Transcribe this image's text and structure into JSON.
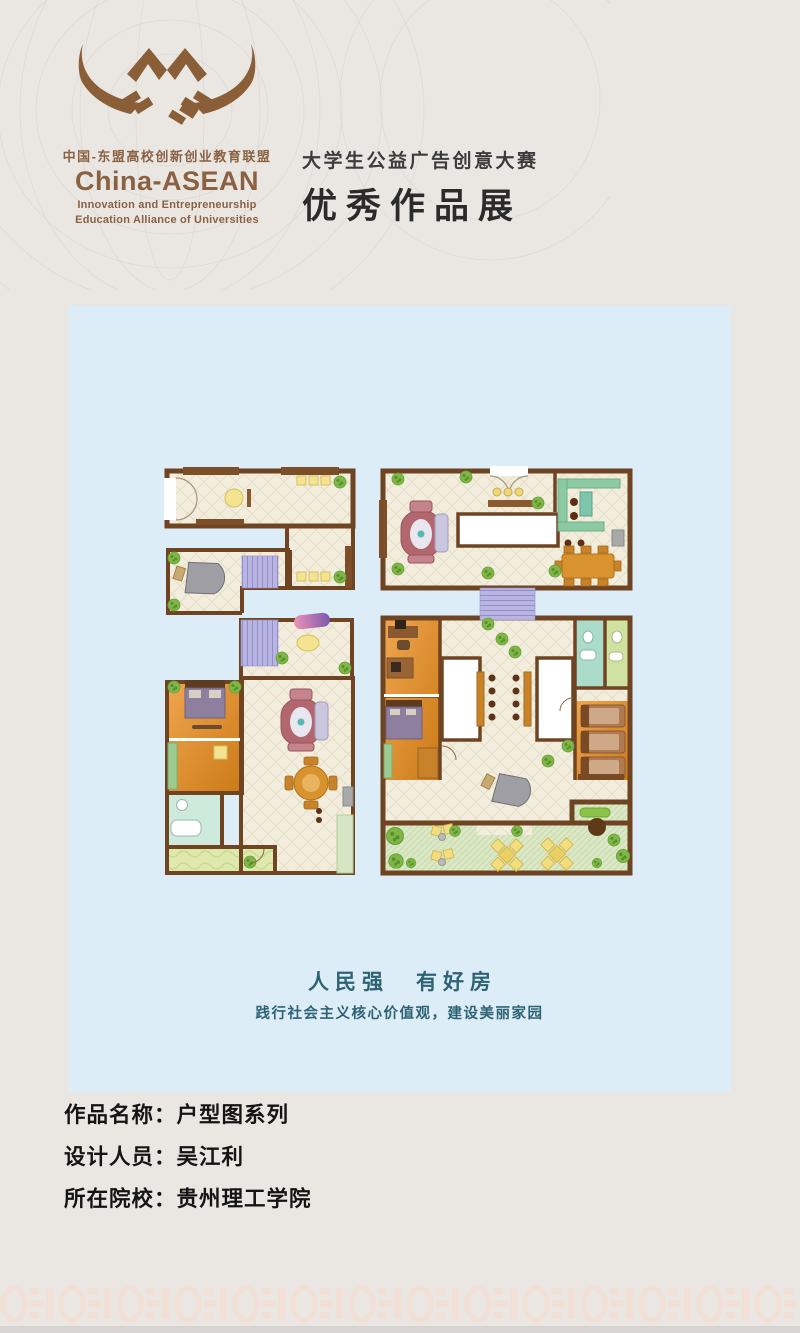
{
  "palette": {
    "page_bg": "#eae7e3",
    "panel_bg": "#ddedf8",
    "brand_brown": "#8a6142",
    "title_dark": "#333333",
    "slogan_teal": "#2e6373",
    "wall_brown": "#6f4423",
    "floor_cream": "#f2eddc",
    "stair_purple": "#b9b5e2",
    "room_orange": "#e0913a",
    "kitchen_green": "#8ccaa4",
    "garden_green": "#dbe8c8",
    "sofa_maroon": "#b2676e",
    "accent_yellow": "#f2e391",
    "pattern_pink": "#f2dfd5"
  },
  "header": {
    "alliance_name_cn": "中国-东盟高校创新创业教育联盟",
    "alliance_name_en": "China-ASEAN",
    "alliance_sub_line1": "Innovation and Entrepreneurship",
    "alliance_sub_line2": "Education Alliance of Universities",
    "event_title": "大学生公益广告创意大赛",
    "event_subtitle": "优秀作品展"
  },
  "poster": {
    "slogan_main": "人民强　有好房",
    "slogan_sub": "践行社会主义核心价值观，建设美丽家园"
  },
  "info": {
    "rows": [
      {
        "label": "作品名称：",
        "value": "户型图系列"
      },
      {
        "label": "设计人员：",
        "value": "吴江利"
      },
      {
        "label": "所在院校：",
        "value": "贵州理工学院"
      }
    ]
  }
}
